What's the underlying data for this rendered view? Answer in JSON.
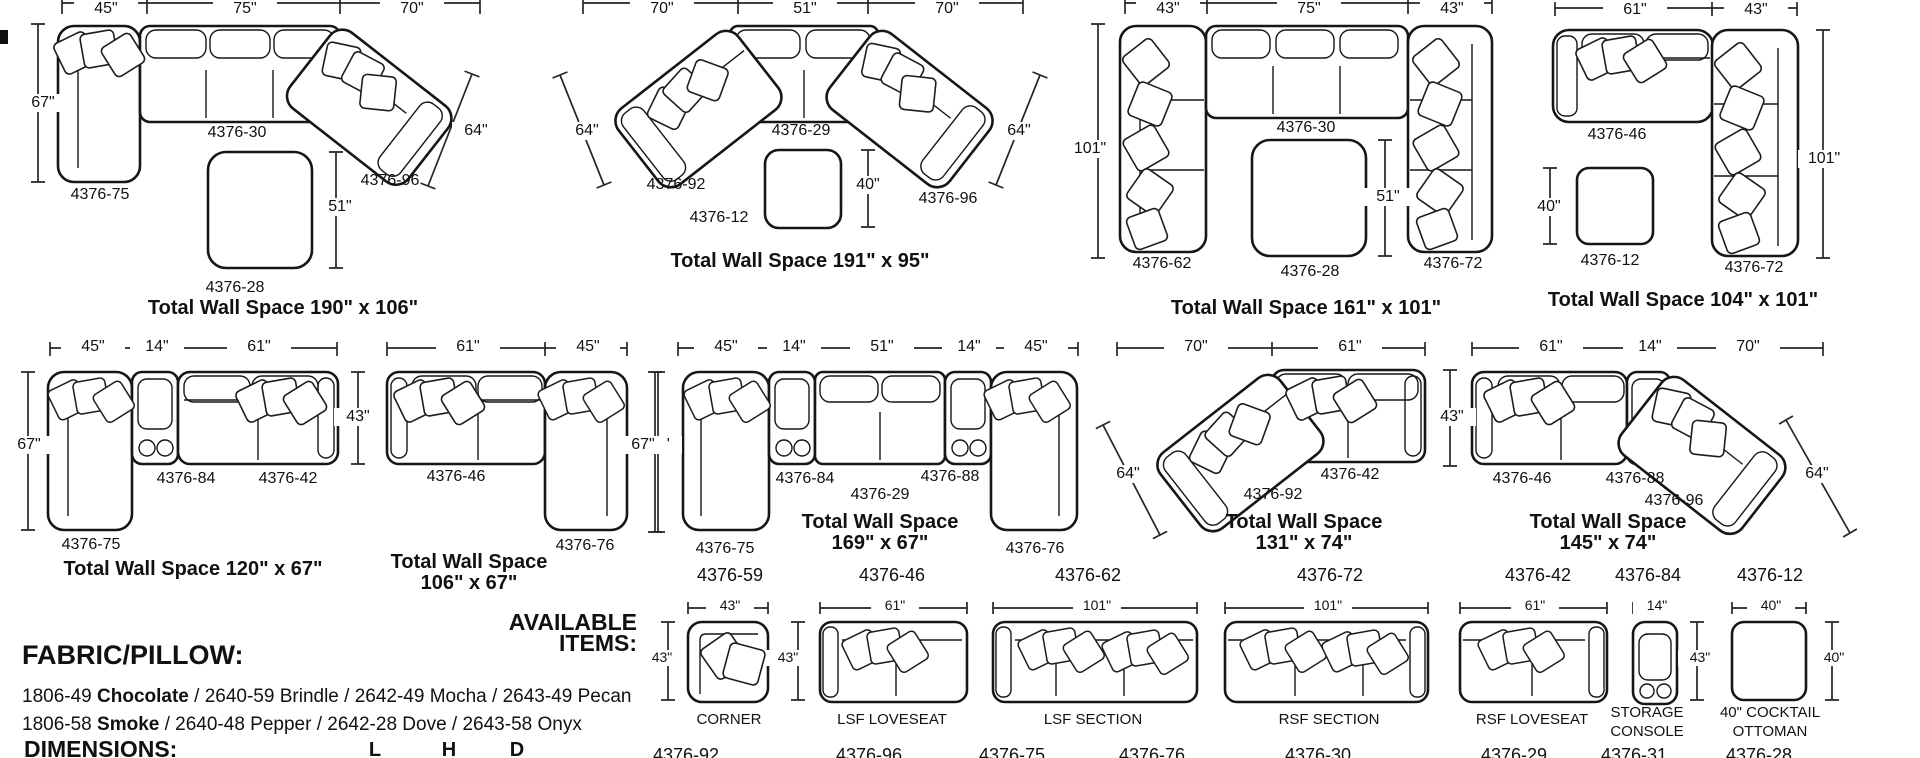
{
  "configs": [
    {
      "dims": [
        "45\"",
        "75\"",
        "70\"",
        "67\"",
        "64\"",
        "51\""
      ],
      "parts": [
        "4376-75",
        "4376-30",
        "4376-96",
        "4376-28"
      ],
      "title": "Total Wall Space 190\" x 106\""
    },
    {
      "dims": [
        "70\"",
        "51\"",
        "70\"",
        "64\"",
        "64\"",
        "40\""
      ],
      "parts": [
        "4376-92",
        "4376-29",
        "4376-12",
        "4376-96"
      ],
      "title": "Total Wall Space 191\" x 95\""
    },
    {
      "dims": [
        "43\"",
        "75\"",
        "43\"",
        "101\"",
        "51\""
      ],
      "parts": [
        "4376-62",
        "4376-30",
        "4376-28",
        "4376-72"
      ],
      "title": "Total Wall Space 161\" x 101\""
    },
    {
      "dims": [
        "61\"",
        "43\"",
        "101\"",
        "40\""
      ],
      "parts": [
        "4376-46",
        "4376-12",
        "4376-72"
      ],
      "title": "Total Wall Space 104\" x 101\""
    },
    {
      "dims": [
        "45\"",
        "14\"",
        "61\"",
        "67\"",
        "43\""
      ],
      "parts": [
        "4376-75",
        "4376-84",
        "4376-42"
      ],
      "title": "Total Wall Space 120\" x 67\""
    },
    {
      "dims": [
        "61\"",
        "45\"",
        "67\""
      ],
      "parts": [
        "4376-46",
        "4376-76"
      ],
      "title_l1": "Total Wall Space",
      "title_l2": "106\" x 67\""
    },
    {
      "dims": [
        "45\"",
        "14\"",
        "51\"",
        "14\"",
        "45\"",
        "67\""
      ],
      "parts": [
        "4376-75",
        "4376-84",
        "4376-29",
        "4376-88",
        "4376-76"
      ],
      "title_l1": "Total Wall Space",
      "title_l2": "169\" x 67\""
    },
    {
      "dims": [
        "70\"",
        "61\"",
        "64\"",
        "43\""
      ],
      "parts": [
        "4376-92",
        "4376-42"
      ],
      "title_l1": "Total Wall Space",
      "title_l2": "131\" x 74\""
    },
    {
      "dims": [
        "61\"",
        "14\"",
        "70\"",
        "64\""
      ],
      "parts": [
        "4376-46",
        "4376-88",
        "4376-96"
      ],
      "title_l1": "Total Wall Space",
      "title_l2": "145\" x 74\""
    }
  ],
  "fabric": {
    "heading": "FABRIC/PILLOW:",
    "line1_code": "1806-49",
    "line1_bold": "Chocolate",
    "line1_rest": " / 2640-59 Brindle / 2642-49 Mocha / 2643-49 Pecan",
    "line2_code": "1806-58",
    "line2_bold": "Smoke",
    "line2_rest": " / 2640-48 Pepper / 2642-28 Dove / 2643-58 Onyx"
  },
  "available": {
    "heading_l1": "AVAILABLE",
    "heading_l2": "ITEMS:",
    "items": [
      {
        "num": "4376-59",
        "width": "43\"",
        "depth": "43\"",
        "caption": "CORNER"
      },
      {
        "num": "4376-46",
        "width": "61\"",
        "depth": "43\"",
        "caption": "LSF LOVESEAT"
      },
      {
        "num": "4376-62",
        "width": "101\"",
        "caption": "LSF SECTION"
      },
      {
        "num": "4376-72",
        "width": "101\"",
        "caption": "RSF SECTION"
      },
      {
        "num": "4376-42",
        "width": "61\"",
        "caption": "RSF LOVESEAT"
      },
      {
        "num": "4376-84",
        "width": "14\"",
        "depth": "43\"",
        "caption_l1": "STORAGE",
        "caption_l2": "CONSOLE"
      },
      {
        "num": "4376-12",
        "width": "40\"",
        "depth": "40\"",
        "caption_l1": "40\" COCKTAIL",
        "caption_l2": "OTTOMAN"
      }
    ]
  },
  "dimensions": {
    "heading": "DIMENSIONS:",
    "col_l": "L",
    "col_h": "H",
    "col_d": "D"
  },
  "bottom_row": [
    "4376-92",
    "4376-96",
    "4376-75",
    "4376-76",
    "4376-30",
    "4376-29",
    "4376-31",
    "4376-28"
  ]
}
